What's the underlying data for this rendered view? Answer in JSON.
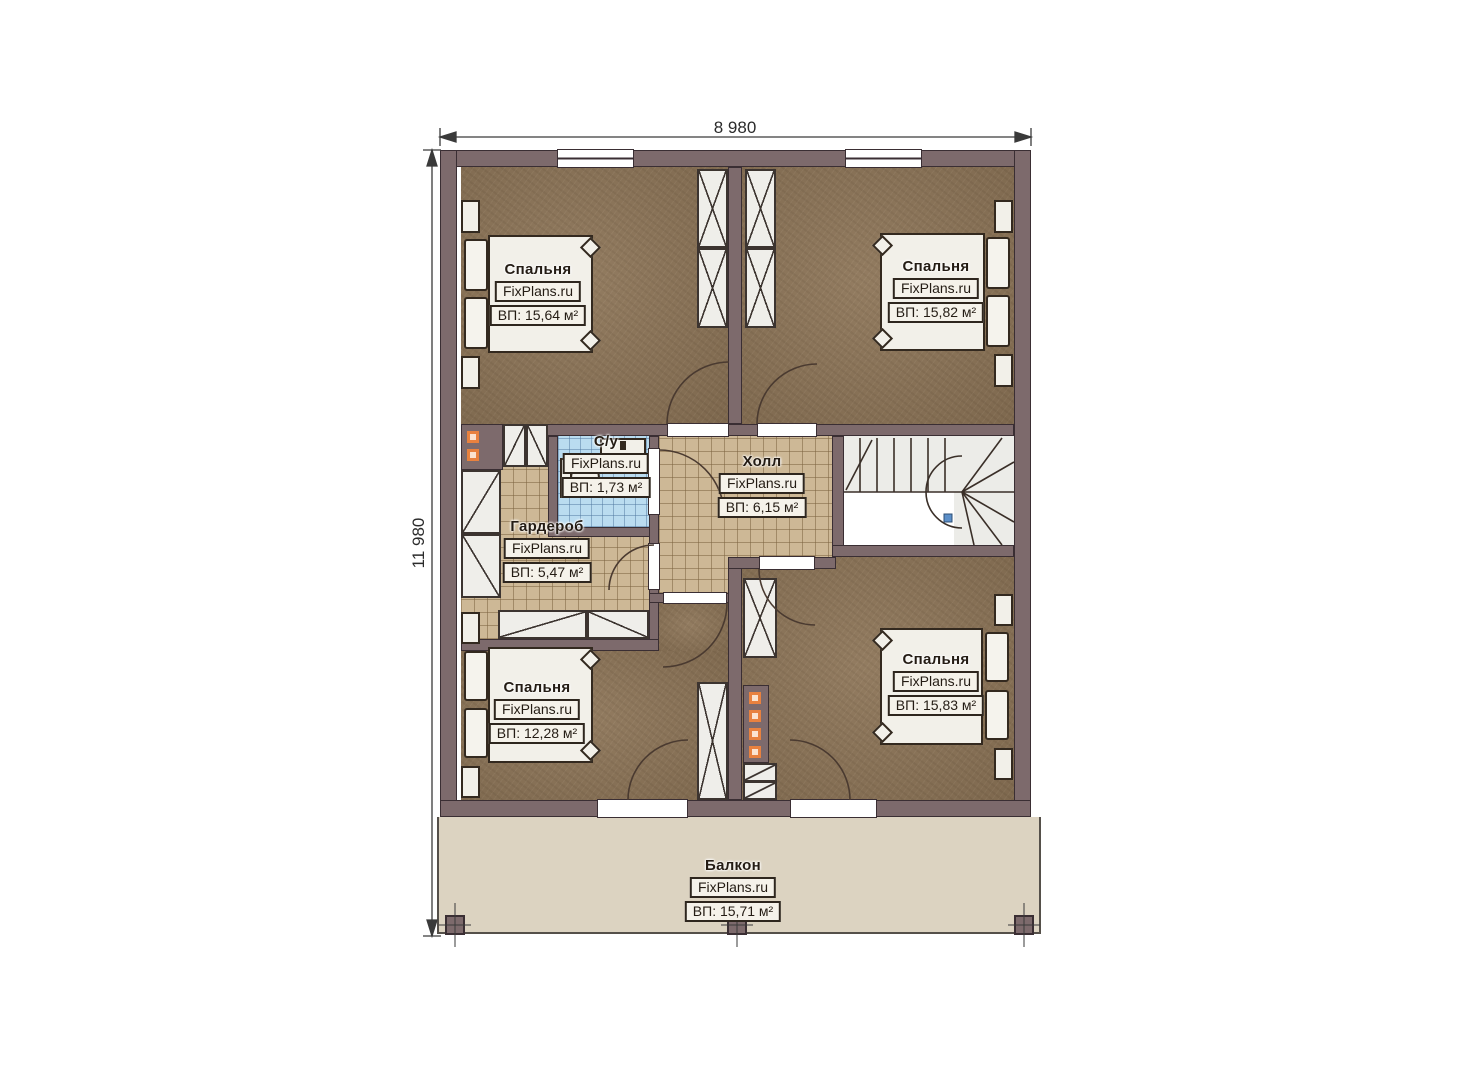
{
  "dimensions": {
    "top": "8 980",
    "left": "11 980"
  },
  "watermark": "FixPlans.ru",
  "rooms": {
    "bedroom_tl": {
      "name": "Спальня",
      "area": "ВП: 15,64 м²"
    },
    "bedroom_tr": {
      "name": "Спальня",
      "area": "ВП: 15,82 м²"
    },
    "bathroom": {
      "name": "С/у",
      "area": "ВП: 1,73 м²"
    },
    "wardrobe": {
      "name": "Гардероб",
      "area": "ВП: 5,47 м²"
    },
    "hall": {
      "name": "Холл",
      "area": "ВП: 6,15 м²"
    },
    "bedroom_bl": {
      "name": "Спальня",
      "area": "ВП: 12,28 м²"
    },
    "bedroom_br": {
      "name": "Спальня",
      "area": "ВП: 15,83 м²"
    },
    "balcony": {
      "name": "Балкон",
      "area": "ВП: 15,71 м²"
    }
  },
  "colors": {
    "wall": "#7d6a6c",
    "wall_outline": "#3a2e33",
    "bedroom_floor": "#8c7457",
    "tile_tan": "#cdb896",
    "tile_blue": "#badcf0",
    "balcony": "#dcd3c1",
    "accent_orange": "#e8813f",
    "stair_marker_blue": "#5b8fc9"
  }
}
